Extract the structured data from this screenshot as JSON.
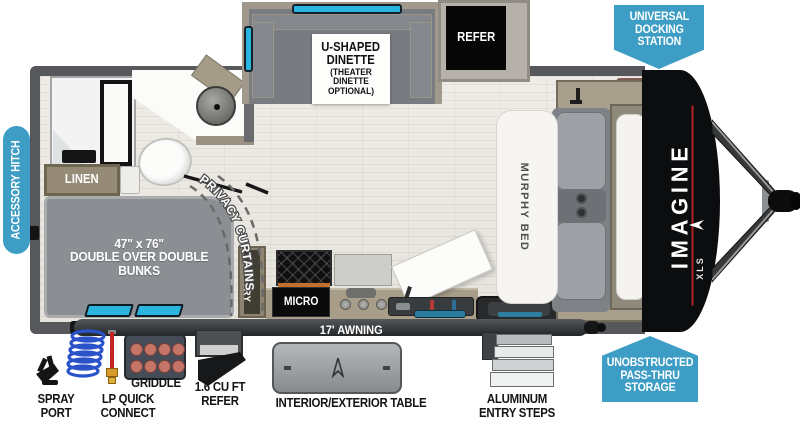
{
  "badges": {
    "accessory_hitch": "ACCESSORY HITCH",
    "universal_docking_station": "UNIVERSAL\nDOCKING\nSTATION",
    "unobstructed_pass_thru": "UNOBSTRUCTED\nPASS-THRU\nSTORAGE"
  },
  "rooms": {
    "dinette_title": "U-SHAPED\nDINETTE",
    "dinette_subtitle": "(THEATER DINETTE\nOPTIONAL)",
    "refer": "REFER",
    "linen": "LINEN",
    "privacy_curtains": "PRIVACY CURTAINS",
    "bunks": "47\" x 76\"\nDOUBLE OVER DOUBLE\nBUNKS",
    "pantry": "PANTRY",
    "micro": "MICRO",
    "murphy_bed": "MURPHY BED",
    "awning": "17' AWNING",
    "brand": "IMAGINE",
    "brand_sub": "XLS"
  },
  "callouts": {
    "spray_port": "SPRAY\nPORT",
    "lp_quick_connect": "LP QUICK\nCONNECT",
    "griddle": "GRIDDLE",
    "exterior_refer": "1.6 CU FT\nREFER",
    "table": "INTERIOR/EXTERIOR TABLE",
    "entry_steps": "ALUMINUM\nENTRY STEPS"
  },
  "colors": {
    "badge_blue": "#3d9dc4",
    "window_cyan": "#2ab5de",
    "cap_black": "#0c0d0f",
    "accent_red": "#b0222a"
  }
}
